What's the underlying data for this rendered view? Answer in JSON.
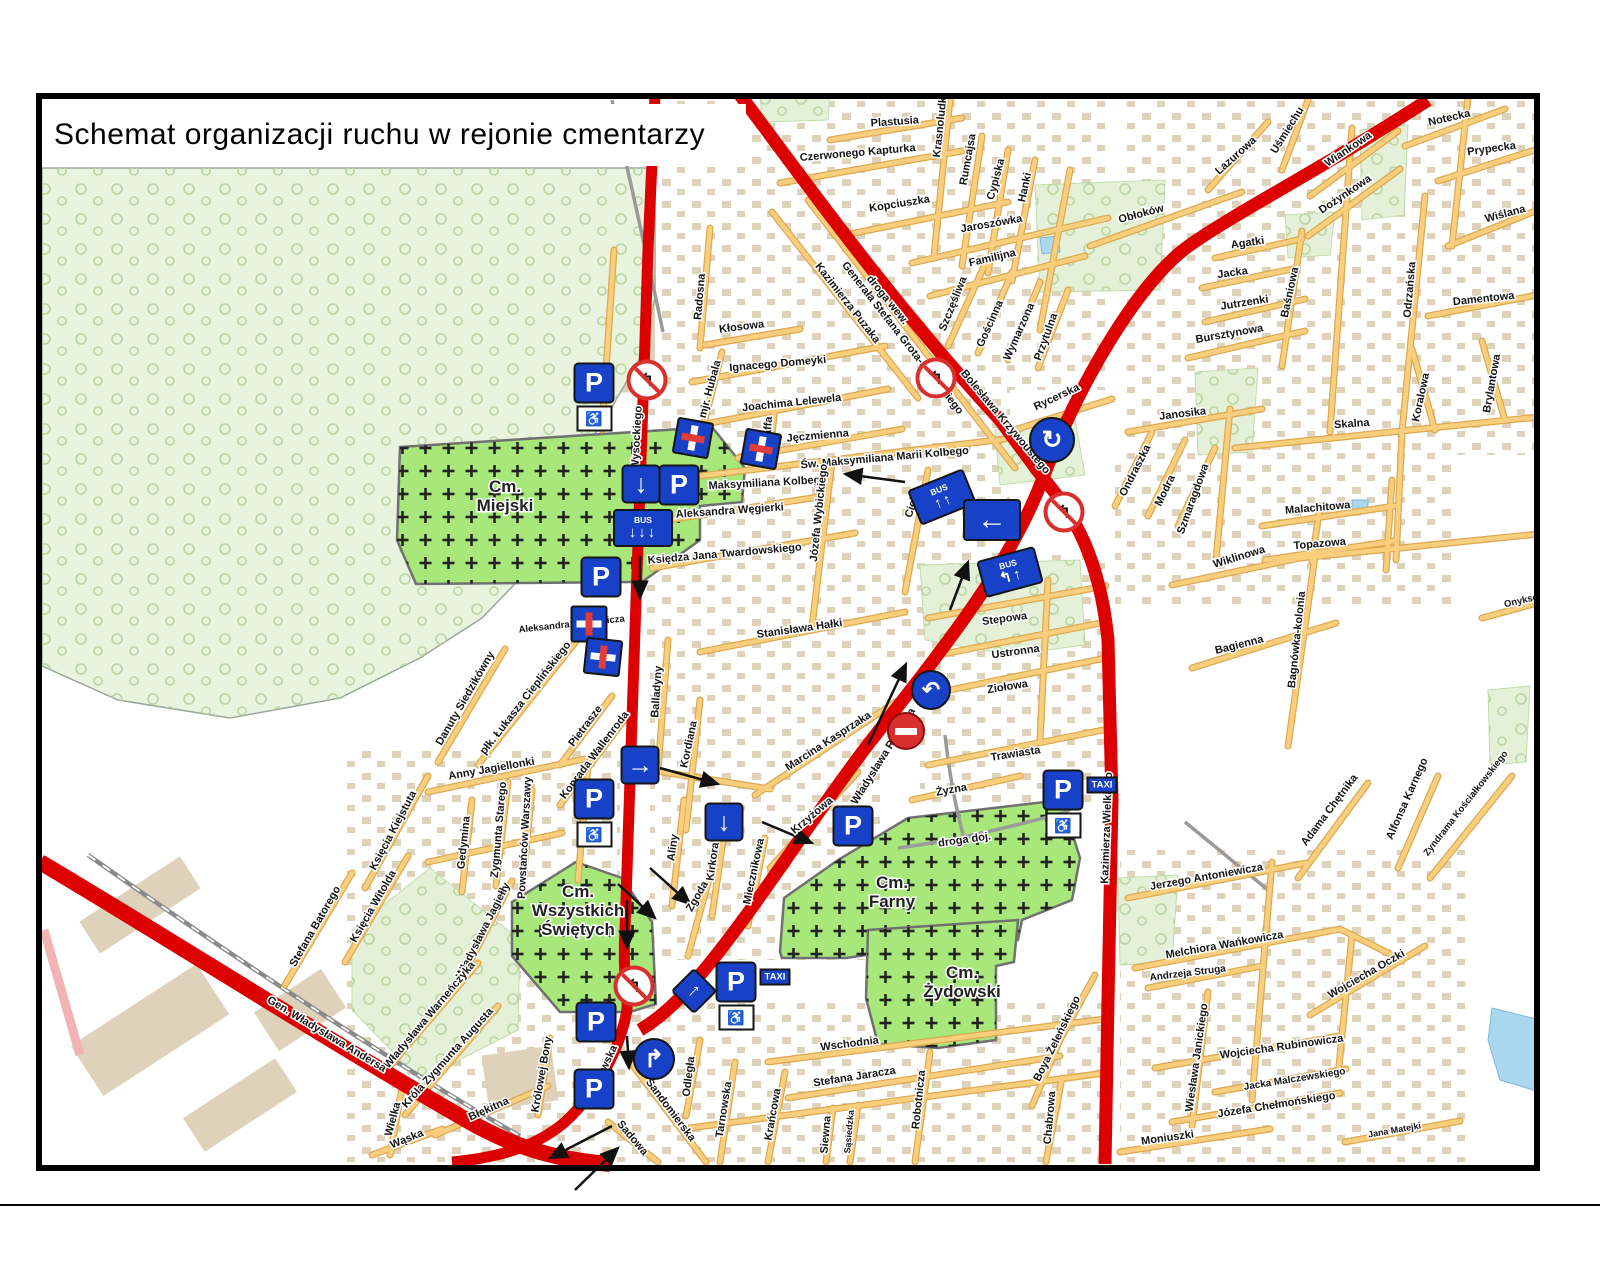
{
  "title": "Schemat organizacji ruchu w rejonie cmentarzy",
  "colors": {
    "road_red": "#dd0000",
    "street_orange": "#f9ce7d",
    "cemetery_green": "#a8e87a",
    "forest_green": "#e9f4de",
    "sign_blue": "#1742c8"
  },
  "map": {
    "icons": {
      "wheelchair": "♿"
    },
    "cemeteries": [
      {
        "lines": [
          "Cm.",
          "Miejski"
        ],
        "x": 505,
        "y": 492
      },
      {
        "lines": [
          "Cm.",
          "Wszystkich",
          "Świętych"
        ],
        "x": 578,
        "y": 897
      },
      {
        "lines": [
          "Cm.",
          "Farny"
        ],
        "x": 892,
        "y": 888
      },
      {
        "lines": [
          "Cm.",
          "Żydowski"
        ],
        "x": 962,
        "y": 978
      }
    ],
    "street_labels": [
      {
        "t": "Skrzatów",
        "x": 120,
        "y": 123,
        "r": -15
      },
      {
        "t": "Plastusia",
        "x": 895,
        "y": 125,
        "r": -4
      },
      {
        "t": "Czerwonego Kapturka",
        "x": 858,
        "y": 156,
        "r": -5
      },
      {
        "t": "Krasnoludków",
        "x": 944,
        "y": 120,
        "r": -84
      },
      {
        "t": "Rumcajsa",
        "x": 971,
        "y": 160,
        "r": -80
      },
      {
        "t": "Cypiska",
        "x": 999,
        "y": 180,
        "r": -75
      },
      {
        "t": "Hanki",
        "x": 1028,
        "y": 188,
        "r": -78
      },
      {
        "t": "Kopciuszka",
        "x": 900,
        "y": 207,
        "r": -9
      },
      {
        "t": "Jaroszówka",
        "x": 992,
        "y": 227,
        "r": -10
      },
      {
        "t": "Familijna",
        "x": 993,
        "y": 261,
        "r": -13
      },
      {
        "t": "Szczęśliwa",
        "x": 956,
        "y": 305,
        "r": -68
      },
      {
        "t": "Gościnna",
        "x": 993,
        "y": 325,
        "r": -66
      },
      {
        "t": "Wymarzona",
        "x": 1022,
        "y": 333,
        "r": -66
      },
      {
        "t": "Przytulna",
        "x": 1049,
        "y": 338,
        "r": -70
      },
      {
        "t": "Obłoków",
        "x": 1142,
        "y": 217,
        "r": -15
      },
      {
        "t": "droga wew.",
        "x": 885,
        "y": 302,
        "r": 51
      },
      {
        "t": "Lazurowa",
        "x": 1238,
        "y": 158,
        "r": -42
      },
      {
        "t": "Uśmiechu",
        "x": 1290,
        "y": 132,
        "r": -58
      },
      {
        "t": "Wiankowa",
        "x": 1350,
        "y": 152,
        "r": -34
      },
      {
        "t": "Dożynkowa",
        "x": 1347,
        "y": 197,
        "r": -34
      },
      {
        "t": "Notecka",
        "x": 1450,
        "y": 121,
        "r": -13
      },
      {
        "t": "Prypecka",
        "x": 1492,
        "y": 152,
        "r": -8
      },
      {
        "t": "Wiślana",
        "x": 1506,
        "y": 217,
        "r": -15
      },
      {
        "t": "Agatki",
        "x": 1248,
        "y": 246,
        "r": -8
      },
      {
        "t": "Jacka",
        "x": 1233,
        "y": 276,
        "r": -8
      },
      {
        "t": "Jutrzenki",
        "x": 1245,
        "y": 306,
        "r": -9
      },
      {
        "t": "Bursztynowa",
        "x": 1230,
        "y": 337,
        "r": -10
      },
      {
        "t": "Baśniowa",
        "x": 1293,
        "y": 293,
        "r": -78
      },
      {
        "t": "Odrzańska",
        "x": 1413,
        "y": 290,
        "r": -85
      },
      {
        "t": "Damentowa",
        "x": 1484,
        "y": 302,
        "r": -6
      },
      {
        "t": "Rycerska",
        "x": 1058,
        "y": 400,
        "r": -25
      },
      {
        "t": "Janosika",
        "x": 1183,
        "y": 417,
        "r": -7
      },
      {
        "t": "Ondraszka",
        "x": 1138,
        "y": 472,
        "r": -63
      },
      {
        "t": "Modra",
        "x": 1168,
        "y": 492,
        "r": -64
      },
      {
        "t": "Szmaragdowa",
        "x": 1196,
        "y": 500,
        "r": -70
      },
      {
        "t": "Bolesława Krzywoustego",
        "x": 1003,
        "y": 424,
        "r": 50
      },
      {
        "t": "Skalna",
        "x": 1352,
        "y": 427,
        "r": -4
      },
      {
        "t": "Koralowa",
        "x": 1424,
        "y": 398,
        "r": -78
      },
      {
        "t": "Brylantowa",
        "x": 1495,
        "y": 384,
        "r": -80
      },
      {
        "t": "Malachitowa",
        "x": 1318,
        "y": 511,
        "r": -5
      },
      {
        "t": "Topazowa",
        "x": 1320,
        "y": 547,
        "r": -5
      },
      {
        "t": "Wiklinowa",
        "x": 1240,
        "y": 560,
        "r": -17
      },
      {
        "t": "Bagienna",
        "x": 1240,
        "y": 648,
        "r": -14
      },
      {
        "t": "Bagnówka-kolonia",
        "x": 1300,
        "y": 640,
        "r": -84
      },
      {
        "t": "Onyksowa",
        "x": 1528,
        "y": 602,
        "r": -13,
        "s": 9.5
      },
      {
        "t": "Kłosowa",
        "x": 742,
        "y": 330,
        "r": -7
      },
      {
        "t": "Ignacego Domeyki",
        "x": 778,
        "y": 367,
        "r": -5
      },
      {
        "t": "mjr. Hubala",
        "x": 713,
        "y": 390,
        "r": -75
      },
      {
        "t": "Joachima Lelewela",
        "x": 792,
        "y": 406,
        "r": -6
      },
      {
        "t": "Jęczmienna",
        "x": 818,
        "y": 439,
        "r": -5
      },
      {
        "t": "Staffa",
        "x": 771,
        "y": 432,
        "r": -86
      },
      {
        "t": "Generała Stefana Grota-Roweckiego",
        "x": 900,
        "y": 340,
        "r": 52
      },
      {
        "t": "Kazimierza Puzaka",
        "x": 845,
        "y": 305,
        "r": 52
      },
      {
        "t": "Św. Maksymiliana Marii Kolbego",
        "x": 885,
        "y": 461,
        "r": -5
      },
      {
        "t": "Maksymiliana Kolbego",
        "x": 768,
        "y": 486,
        "r": -3
      },
      {
        "t": "Aleksandra Węgierki",
        "x": 730,
        "y": 514,
        "r": -4
      },
      {
        "t": "Księdza Jana Twardowskiego",
        "x": 725,
        "y": 557,
        "r": -5
      },
      {
        "t": "Józefa Wybickiego",
        "x": 822,
        "y": 513,
        "r": -84
      },
      {
        "t": "Cicha",
        "x": 916,
        "y": 504,
        "r": -72
      },
      {
        "t": "Stanisława Hałki",
        "x": 800,
        "y": 632,
        "r": -8
      },
      {
        "t": "Wysockiego",
        "x": 640,
        "y": 438,
        "r": -87
      },
      {
        "t": "Radosna",
        "x": 703,
        "y": 297,
        "r": -85
      },
      {
        "t": "Aleksandra Karpowicza",
        "x": 572,
        "y": 627,
        "r": -6,
        "s": 9.5
      },
      {
        "t": "Stepowa",
        "x": 1005,
        "y": 622,
        "r": -8
      },
      {
        "t": "Ustronna",
        "x": 1016,
        "y": 655,
        "r": -8
      },
      {
        "t": "Ziołowa",
        "x": 1008,
        "y": 690,
        "r": -9
      },
      {
        "t": "Trawiasta",
        "x": 1016,
        "y": 757,
        "r": -9
      },
      {
        "t": "Żyzna",
        "x": 952,
        "y": 793,
        "r": -10
      },
      {
        "t": "droga doj.",
        "x": 965,
        "y": 843,
        "r": -8
      },
      {
        "t": "Balladyny",
        "x": 660,
        "y": 692,
        "r": -86
      },
      {
        "t": "Kordiana",
        "x": 692,
        "y": 745,
        "r": -78
      },
      {
        "t": "Aliny",
        "x": 676,
        "y": 848,
        "r": -82
      },
      {
        "t": "Kirkora",
        "x": 716,
        "y": 862,
        "r": -82
      },
      {
        "t": "Zgoda",
        "x": 700,
        "y": 898,
        "r": -60
      },
      {
        "t": "Miecznikowa",
        "x": 757,
        "y": 872,
        "r": -78
      },
      {
        "t": "Krzyżowa",
        "x": 814,
        "y": 818,
        "r": -40
      },
      {
        "t": "Marcina Kasprzaka",
        "x": 830,
        "y": 744,
        "r": -33
      },
      {
        "t": "Władysława Raginisa",
        "x": 886,
        "y": 758,
        "r": -58
      },
      {
        "t": "Danuty Siedzikówny",
        "x": 468,
        "y": 700,
        "r": -60
      },
      {
        "t": "płk. Łukasza Cieplińskiego",
        "x": 528,
        "y": 700,
        "r": -52
      },
      {
        "t": "Pietrasze",
        "x": 588,
        "y": 728,
        "r": -53
      },
      {
        "t": "Konrada Wallenroda",
        "x": 597,
        "y": 757,
        "r": -53
      },
      {
        "t": "Anny Jagiellonki",
        "x": 492,
        "y": 772,
        "r": -10
      },
      {
        "t": "Zygmunta Starego",
        "x": 502,
        "y": 830,
        "r": -85
      },
      {
        "t": "Powstańców Warszawy",
        "x": 528,
        "y": 838,
        "r": -87
      },
      {
        "t": "Gedymina",
        "x": 467,
        "y": 843,
        "r": -84
      },
      {
        "t": "Księcia Kiejstuta",
        "x": 396,
        "y": 832,
        "r": -62
      },
      {
        "t": "Księcia Witolda",
        "x": 376,
        "y": 908,
        "r": -60
      },
      {
        "t": "Stefana Batorego",
        "x": 318,
        "y": 928,
        "r": -60
      },
      {
        "t": "Władysława Jagiełły",
        "x": 486,
        "y": 932,
        "r": -63
      },
      {
        "t": "Władysława Warneńczyka",
        "x": 432,
        "y": 1017,
        "r": -50
      },
      {
        "t": "Króla Zygmunta Augusta",
        "x": 450,
        "y": 1060,
        "r": -48
      },
      {
        "t": "Królowej Bony",
        "x": 545,
        "y": 1075,
        "r": -80
      },
      {
        "t": "Błękitna",
        "x": 490,
        "y": 1112,
        "r": -24
      },
      {
        "t": "Wielka",
        "x": 396,
        "y": 1120,
        "r": -75
      },
      {
        "t": "Wąska",
        "x": 408,
        "y": 1142,
        "r": -22
      },
      {
        "t": "Gen. Władysława Andersa",
        "x": 325,
        "y": 1037,
        "r": 31
      },
      {
        "t": "Wasilkowska",
        "x": 603,
        "y": 1078,
        "r": -65
      },
      {
        "t": "Sandomierska",
        "x": 668,
        "y": 1112,
        "r": 53
      },
      {
        "t": "Sadowa",
        "x": 630,
        "y": 1140,
        "r": 50
      },
      {
        "t": "Odległa",
        "x": 692,
        "y": 1077,
        "r": -83
      },
      {
        "t": "Tarnowska",
        "x": 727,
        "y": 1110,
        "r": -81
      },
      {
        "t": "Krańcowa",
        "x": 776,
        "y": 1115,
        "r": -80
      },
      {
        "t": "Siewna",
        "x": 829,
        "y": 1135,
        "r": -85
      },
      {
        "t": "Sąsiedzka",
        "x": 852,
        "y": 1132,
        "r": -85,
        "s": 9
      },
      {
        "t": "Wschodnia",
        "x": 850,
        "y": 1047,
        "r": -7
      },
      {
        "t": "Stefana Jaracza",
        "x": 855,
        "y": 1080,
        "r": -9
      },
      {
        "t": "Robotnicza",
        "x": 922,
        "y": 1100,
        "r": -84
      },
      {
        "t": "Chabrowa",
        "x": 1053,
        "y": 1118,
        "r": -85
      },
      {
        "t": "Boya Żeleńskiego",
        "x": 1060,
        "y": 1040,
        "r": -64
      },
      {
        "t": "Kazimierza Wielkiego",
        "x": 1110,
        "y": 828,
        "r": -88
      },
      {
        "t": "Jerzego Antoniewicza",
        "x": 1207,
        "y": 880,
        "r": -10
      },
      {
        "t": "Melchiora Wańkowicza",
        "x": 1225,
        "y": 948,
        "r": -10
      },
      {
        "t": "Andrzeja Struga",
        "x": 1188,
        "y": 976,
        "r": -7,
        "s": 10
      },
      {
        "t": "Wiesława Janickiego",
        "x": 1200,
        "y": 1058,
        "r": -82
      },
      {
        "t": "Wojciecha Rubinowicza",
        "x": 1282,
        "y": 1050,
        "r": -8
      },
      {
        "t": "Jacka Malczewskiego",
        "x": 1295,
        "y": 1082,
        "r": -9,
        "s": 10
      },
      {
        "t": "Józefa Chełmońskiego",
        "x": 1277,
        "y": 1108,
        "r": -9
      },
      {
        "t": "Moniuszki",
        "x": 1168,
        "y": 1141,
        "r": -8
      },
      {
        "t": "Jana Matejki",
        "x": 1395,
        "y": 1133,
        "r": -10,
        "s": 9
      },
      {
        "t": "Wojciecha Oczki",
        "x": 1368,
        "y": 977,
        "r": -30
      },
      {
        "t": "Adama Chętnika",
        "x": 1332,
        "y": 812,
        "r": -53
      },
      {
        "t": "Alfonsa Karnego",
        "x": 1410,
        "y": 800,
        "r": -66
      },
      {
        "t": "Zyndrama Kościałkowskiego",
        "x": 1468,
        "y": 805,
        "r": -52,
        "s": 9.5
      }
    ],
    "signs": [
      {
        "type": "no-left-turn",
        "x": 647,
        "y": 380,
        "glyph": "↰"
      },
      {
        "type": "parking",
        "x": 594,
        "y": 397,
        "label": "P",
        "wheelchair": true
      },
      {
        "type": "dead-end",
        "x": 693,
        "y": 438,
        "r": 10
      },
      {
        "type": "dead-end",
        "x": 761,
        "y": 449,
        "r": 10
      },
      {
        "type": "oneway",
        "x": 641,
        "y": 484,
        "glyph": "↓"
      },
      {
        "type": "parking",
        "x": 679,
        "y": 485,
        "label": "P"
      },
      {
        "type": "bus-board",
        "x": 643,
        "y": 528,
        "label": "BUS",
        "glyph": "↓↓↓",
        "r": 0
      },
      {
        "type": "parking",
        "x": 601,
        "y": 577,
        "label": "P"
      },
      {
        "type": "dead-end",
        "x": 589,
        "y": 624,
        "r": 90
      },
      {
        "type": "dead-end",
        "x": 603,
        "y": 657,
        "r": 96
      },
      {
        "type": "oneway",
        "x": 640,
        "y": 765,
        "glyph": "→"
      },
      {
        "type": "parking",
        "x": 594,
        "y": 813,
        "label": "P",
        "wheelchair": true
      },
      {
        "type": "oneway",
        "x": 724,
        "y": 822,
        "glyph": "↓"
      },
      {
        "type": "parking",
        "x": 853,
        "y": 826,
        "label": "P"
      },
      {
        "type": "parking",
        "x": 1063,
        "y": 804,
        "label": "P",
        "taxi": "TAXI",
        "wheelchair": true
      },
      {
        "type": "no-left-turn",
        "x": 936,
        "y": 378,
        "glyph": "↰"
      },
      {
        "type": "bus-board",
        "x": 942,
        "y": 497,
        "label": "BUS",
        "glyph": "↑↑",
        "r": -22
      },
      {
        "type": "arrow-board",
        "x": 992,
        "y": 520,
        "glyph": "←"
      },
      {
        "type": "roundabout",
        "x": 1052,
        "y": 440,
        "glyph": "↻"
      },
      {
        "type": "no-left-turn",
        "x": 1064,
        "y": 512,
        "glyph": "↰"
      },
      {
        "type": "bus-board",
        "x": 1010,
        "y": 572,
        "label": "BUS",
        "glyph": "↰↑",
        "r": -15
      },
      {
        "type": "u-turn",
        "x": 931,
        "y": 690,
        "glyph": "↶"
      },
      {
        "type": "no-entry",
        "x": 906,
        "y": 731
      },
      {
        "type": "no-left-turn",
        "x": 634,
        "y": 986,
        "glyph": "↰"
      },
      {
        "type": "keep-right",
        "x": 694,
        "y": 991,
        "glyph": "↑",
        "r": 45
      },
      {
        "type": "parking",
        "x": 736,
        "y": 996,
        "label": "P",
        "taxi": "TAXI",
        "wheelchair": true
      },
      {
        "type": "right-turn",
        "x": 654,
        "y": 1059,
        "glyph": "↱"
      },
      {
        "type": "parking",
        "x": 596,
        "y": 1022,
        "label": "P"
      },
      {
        "type": "parking",
        "x": 594,
        "y": 1089,
        "label": "P"
      }
    ],
    "arrows": [
      [
        905,
        482,
        845,
        474
      ],
      [
        950,
        610,
        968,
        562
      ],
      [
        868,
        745,
        906,
        664
      ],
      [
        640,
        556,
        640,
        598
      ],
      [
        627,
        900,
        627,
        948
      ],
      [
        612,
        1126,
        550,
        1158
      ],
      [
        575,
        1190,
        618,
        1148
      ],
      [
        660,
        768,
        718,
        784
      ],
      [
        762,
        822,
        812,
        843
      ],
      [
        650,
        868,
        690,
        904
      ],
      [
        618,
        884,
        655,
        918
      ],
      [
        627,
        1036,
        629,
        1068
      ]
    ]
  }
}
